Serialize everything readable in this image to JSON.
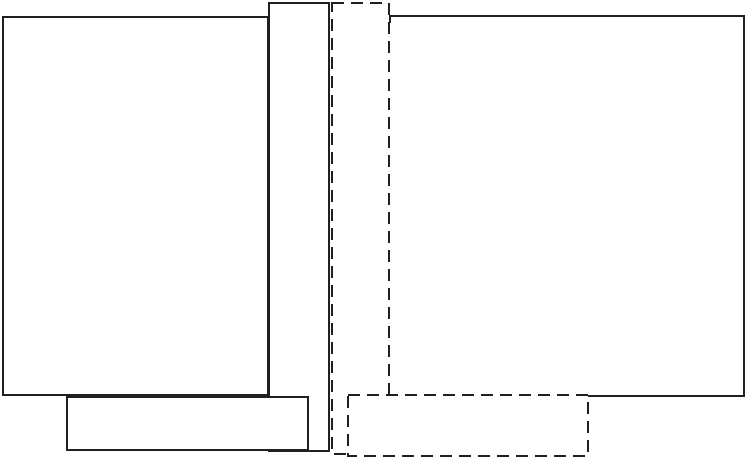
{
  "canvas": {
    "width": 748,
    "height": 459,
    "background": "#ffffff"
  },
  "diagram": {
    "type": "overlapping-rectangles",
    "stroke_color": "#231f20",
    "fill_color": "#ffffff",
    "stroke_width": 2,
    "dash_pattern": "12 7",
    "shapes": [
      {
        "name": "left-large-rect",
        "border": "solid",
        "shape": "rect",
        "x": 3,
        "y": 17,
        "width": 265,
        "height": 378
      },
      {
        "name": "center-tall-rect",
        "border": "solid",
        "shape": "rect",
        "x": 269,
        "y": 3,
        "width": 60,
        "height": 448
      },
      {
        "name": "bottom-left-rect",
        "border": "solid",
        "shape": "rect",
        "x": 67,
        "y": 397,
        "width": 241,
        "height": 53
      },
      {
        "name": "right-large-rect",
        "border": "solid",
        "shape": "path",
        "points": [
          [
            390,
            23
          ],
          [
            390,
            16
          ],
          [
            744,
            16
          ],
          [
            744,
            396
          ],
          [
            390,
            396
          ]
        ]
      },
      {
        "name": "center-tall-dashed-outline",
        "border": "dashed",
        "shape": "rect",
        "x": 332,
        "y": 3,
        "width": 57,
        "height": 451
      },
      {
        "name": "bottom-center-dashed-outline",
        "border": "dashed",
        "shape": "rect",
        "x": 348,
        "y": 395,
        "width": 240,
        "height": 61
      }
    ]
  }
}
